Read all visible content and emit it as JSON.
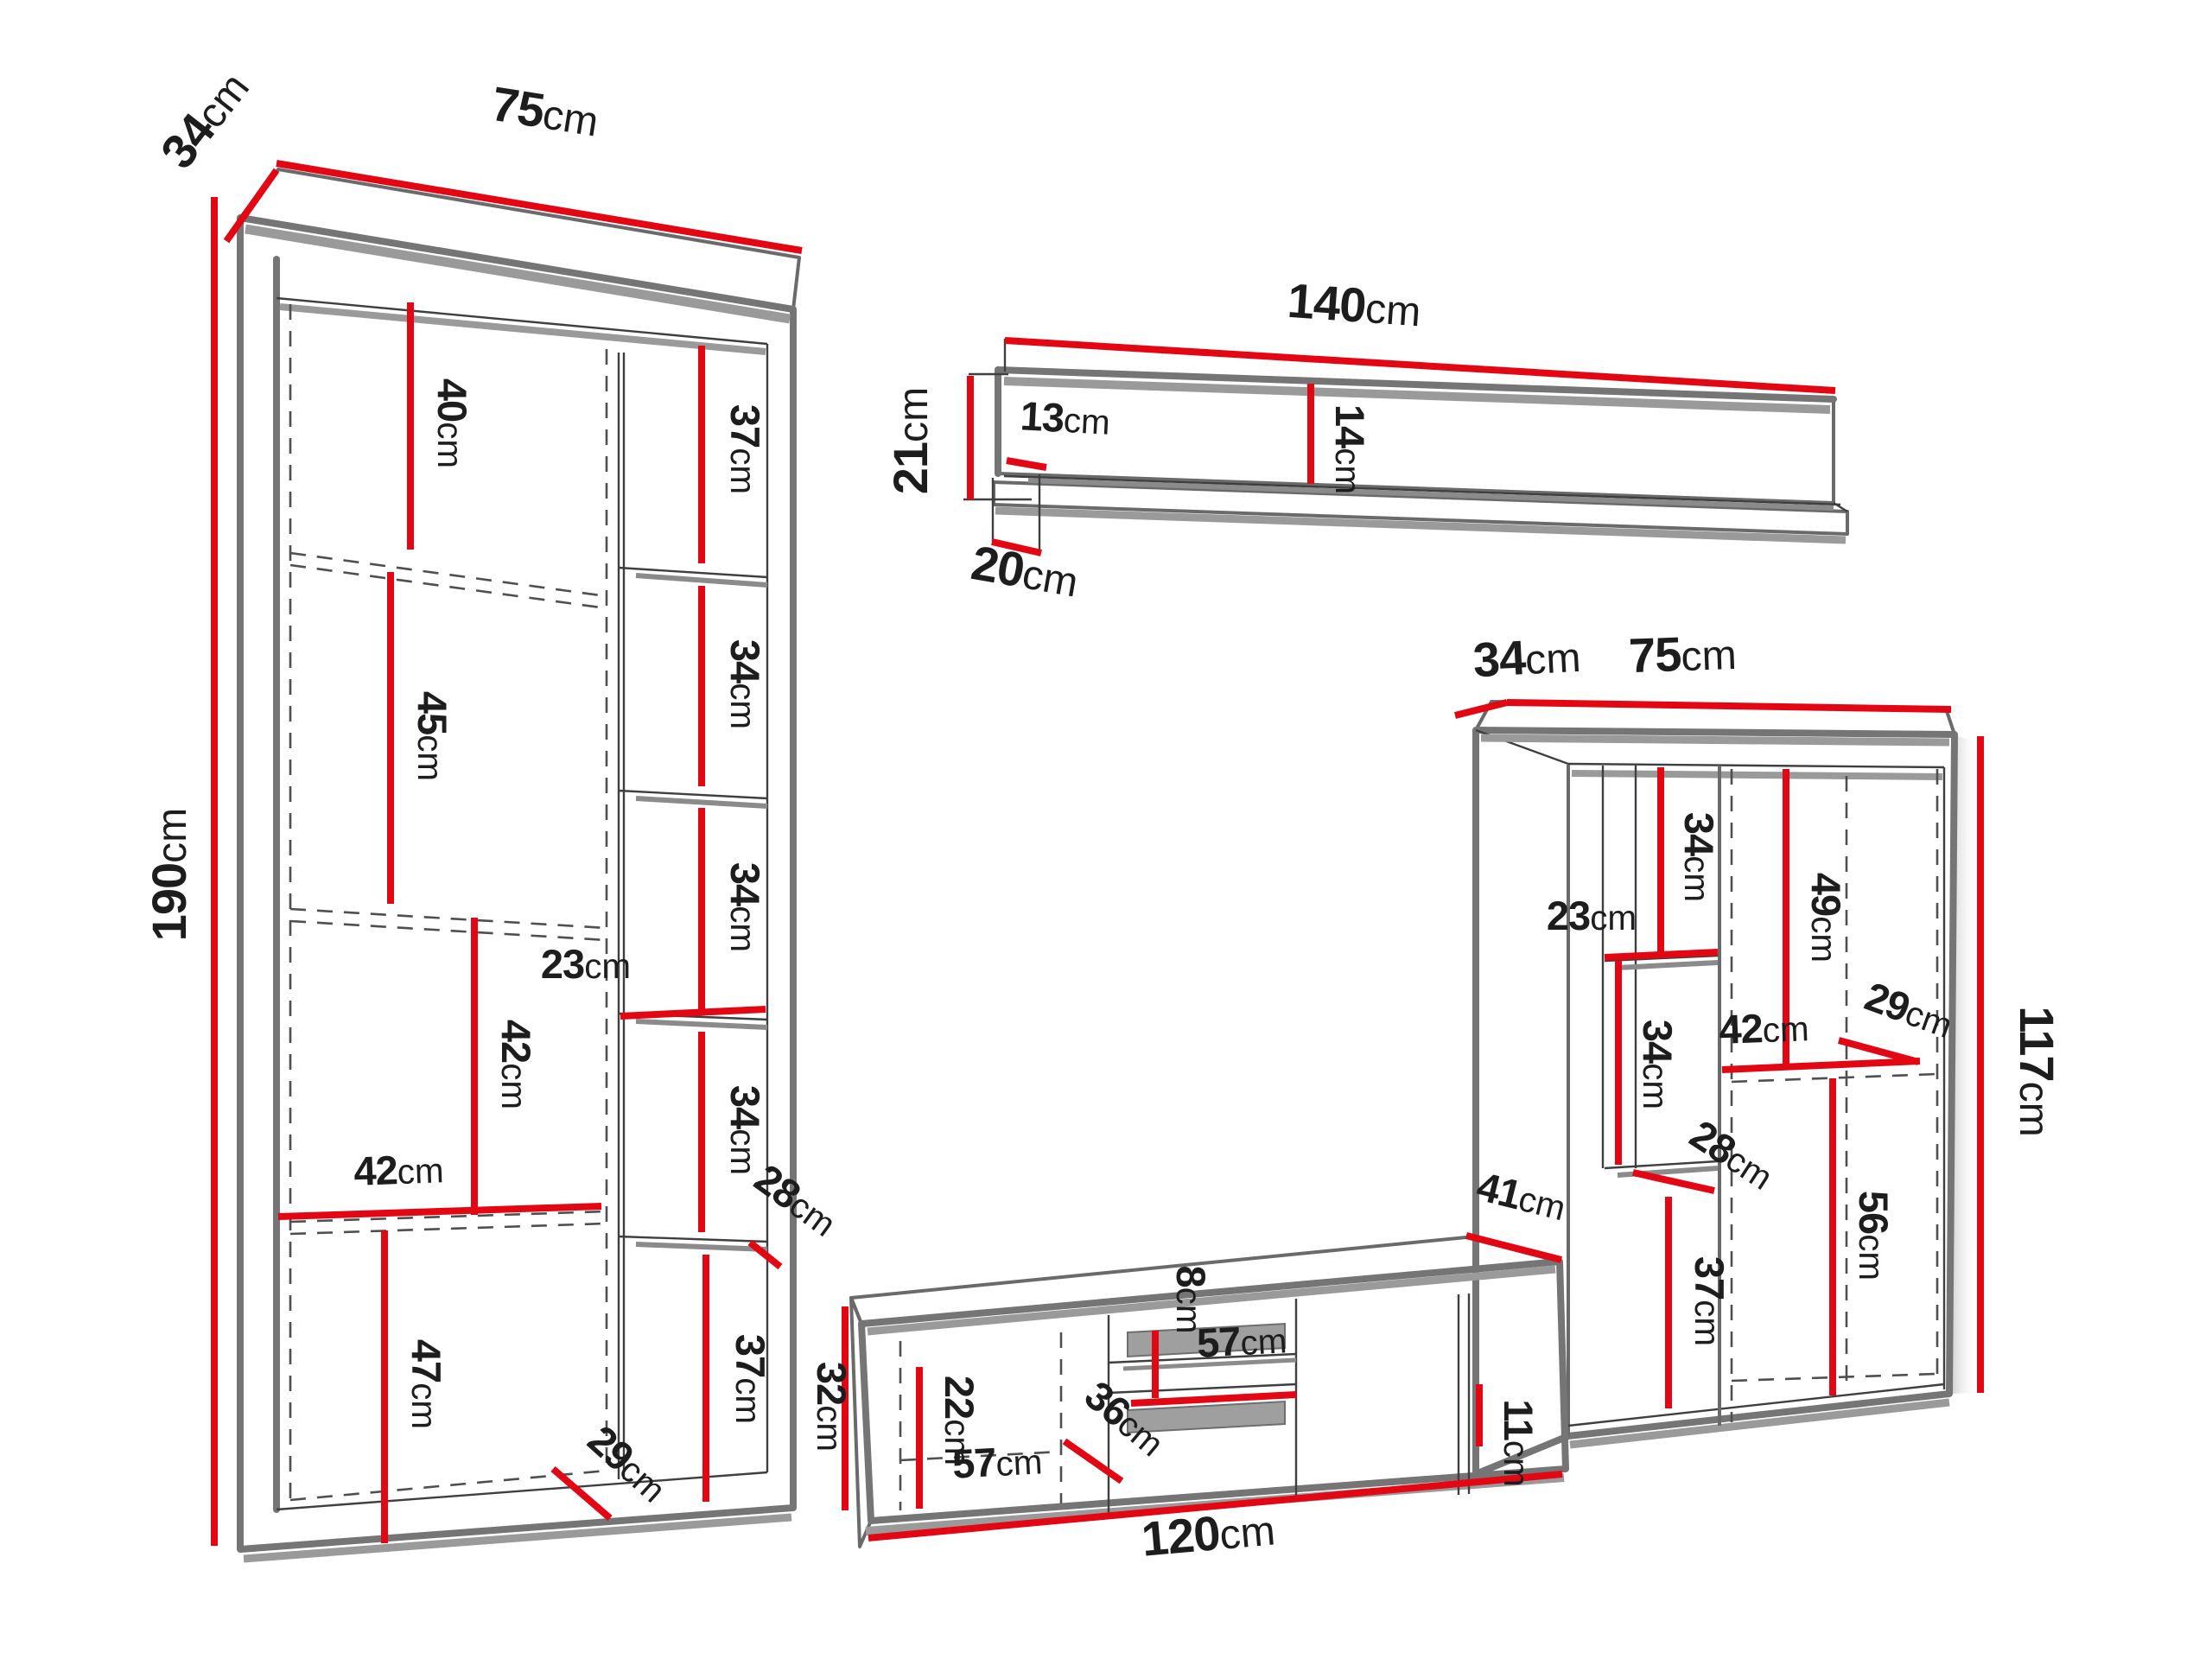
{
  "units": "cm",
  "colors": {
    "dimension_line": "#e30613",
    "outline_gray": "#757575",
    "detail_line": "#3f3f3f",
    "shadow_gray": "#9a9a9a",
    "label_text": "#1d1d1d",
    "background": "#ffffff"
  },
  "left_cabinet": {
    "width": {
      "v": "75",
      "u": "cm"
    },
    "depth": {
      "v": "34",
      "u": "cm"
    },
    "height": {
      "v": "190",
      "u": "cm"
    },
    "section_1": {
      "v": "40",
      "u": "cm"
    },
    "section_2": {
      "v": "45",
      "u": "cm"
    },
    "section_3": {
      "v": "42",
      "u": "cm"
    },
    "section_4": {
      "v": "47",
      "u": "cm"
    },
    "inner_width": {
      "v": "42",
      "u": "cm"
    },
    "base": {
      "v": "29",
      "u": "cm"
    },
    "shelf_1": {
      "v": "37",
      "u": "cm"
    },
    "shelf_2": {
      "v": "34",
      "u": "cm"
    },
    "shelf_3": {
      "v": "34",
      "u": "cm"
    },
    "shelf_width": {
      "v": "23",
      "u": "cm"
    },
    "shelf_4": {
      "v": "34",
      "u": "cm"
    },
    "shelf_depth": {
      "v": "28",
      "u": "cm"
    },
    "shelf_5": {
      "v": "37",
      "u": "cm"
    }
  },
  "wall_shelf": {
    "width": {
      "v": "140",
      "u": "cm"
    },
    "total_height": {
      "v": "21",
      "u": "cm"
    },
    "back_height": {
      "v": "13",
      "u": "cm"
    },
    "front_height": {
      "v": "14",
      "u": "cm"
    },
    "depth": {
      "v": "20",
      "u": "cm"
    }
  },
  "right_cabinet": {
    "depth": {
      "v": "34",
      "u": "cm"
    },
    "width": {
      "v": "75",
      "u": "cm"
    },
    "height": {
      "v": "117",
      "u": "cm"
    },
    "shelf_top": {
      "v": "34",
      "u": "cm"
    },
    "column_width": {
      "v": "23",
      "u": "cm"
    },
    "shelf_mid": {
      "v": "34",
      "u": "cm"
    },
    "shelf_depth": {
      "v": "28",
      "u": "cm"
    },
    "shelf_bottom": {
      "v": "37",
      "u": "cm"
    },
    "right_top": {
      "v": "49",
      "u": "cm"
    },
    "right_width": {
      "v": "42",
      "u": "cm"
    },
    "right_depth": {
      "v": "29",
      "u": "cm"
    },
    "right_bottom": {
      "v": "56",
      "u": "cm"
    }
  },
  "tv_stand": {
    "width": {
      "v": "120",
      "u": "cm"
    },
    "height": {
      "v": "32",
      "u": "cm"
    },
    "depth": {
      "v": "41",
      "u": "cm"
    },
    "door_height": {
      "v": "22",
      "u": "cm"
    },
    "door_width": {
      "v": "57",
      "u": "cm"
    },
    "door_depth": {
      "v": "36",
      "u": "cm"
    },
    "niche_height": {
      "v": "8",
      "u": "cm"
    },
    "niche_width": {
      "v": "57",
      "u": "cm"
    },
    "base_height": {
      "v": "11",
      "u": "cm"
    }
  }
}
